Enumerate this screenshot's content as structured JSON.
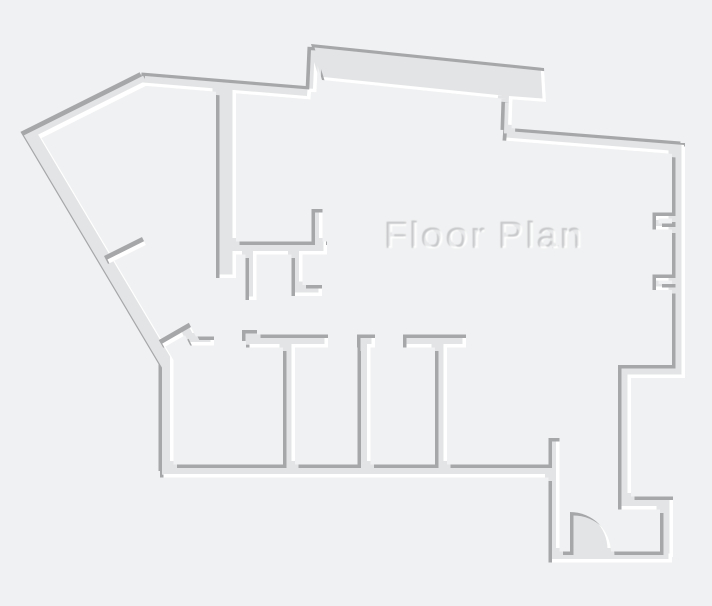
{
  "title": {
    "text": "Floor Plan"
  },
  "colors": {
    "background": "#f0f1f2",
    "wall_fill": "#e3e4e5",
    "edge_shadow": "#a6a7a9",
    "edge_highlight": "#ffffff",
    "title_fill": "#e7e8e9",
    "title_shadow": "#c6c7c9"
  },
  "features": {
    "door_swing": "quarter-circle door swing, bottom-right entrance",
    "door_leaf_count": 2,
    "window_notch_count": 2,
    "room_count_bottom_row": 4
  }
}
